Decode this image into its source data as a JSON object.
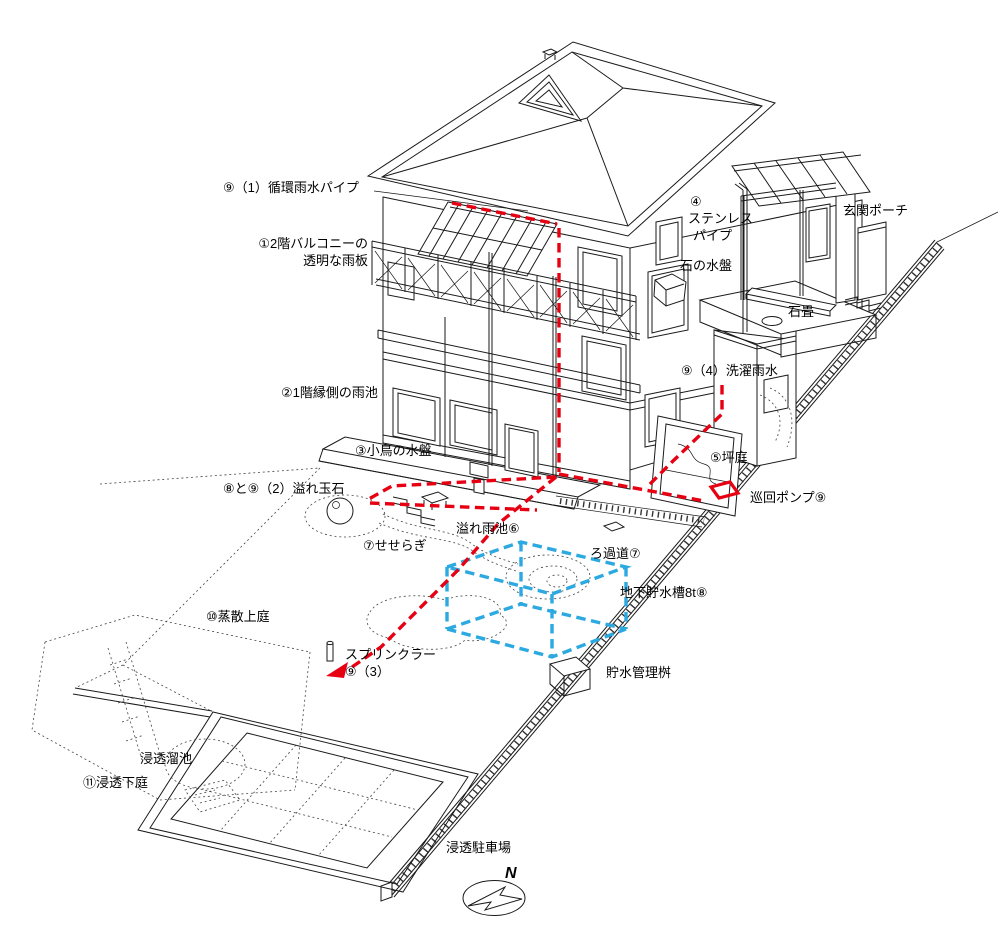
{
  "diagram": {
    "labels": {
      "circulation_pipe": "⑨（1）循環雨水パイプ",
      "balcony_line1": "①2階バルコニーの",
      "balcony_line2": "透明な雨板",
      "engawa_pond": "②1階縁側の雨池",
      "bird_basin": "③小鳥の水盤",
      "overflow_stones": "⑧と⑨（2）溢れ玉石",
      "seseragi": "⑦せせらぎ",
      "overflow_pond": "溢れ雨池⑥",
      "filter_path": "ろ過道⑦",
      "underground_tank": "地下貯水槽8t⑧",
      "evaporation_garden": "⑩蒸散上庭",
      "sprinkler_line1": "スプリンクラー",
      "sprinkler_line2": "⑨（3）",
      "storage_management_box": "貯水管理桝",
      "infiltration_pond": "浸透溜池",
      "infiltration_garden": "⑪浸透下庭",
      "infiltration_parking": "浸透駐車場",
      "stainless_line1": "④",
      "stainless_line2": "ステンレス",
      "stainless_line3": "パイプ",
      "entrance_porch": "玄関ポーチ",
      "stone_basin": "石の水盤",
      "stone_pavement": "石畳",
      "laundry_rainwater": "⑨（4）洗濯雨水",
      "tsubo_garden": "⑤坪庭",
      "circulation_pump": "巡回ポンプ⑨",
      "compass_north": "N"
    },
    "colors": {
      "pipe_red": "#e60012",
      "tank_blue": "#2ca9e1",
      "line_black": "#1a1a1a"
    }
  }
}
